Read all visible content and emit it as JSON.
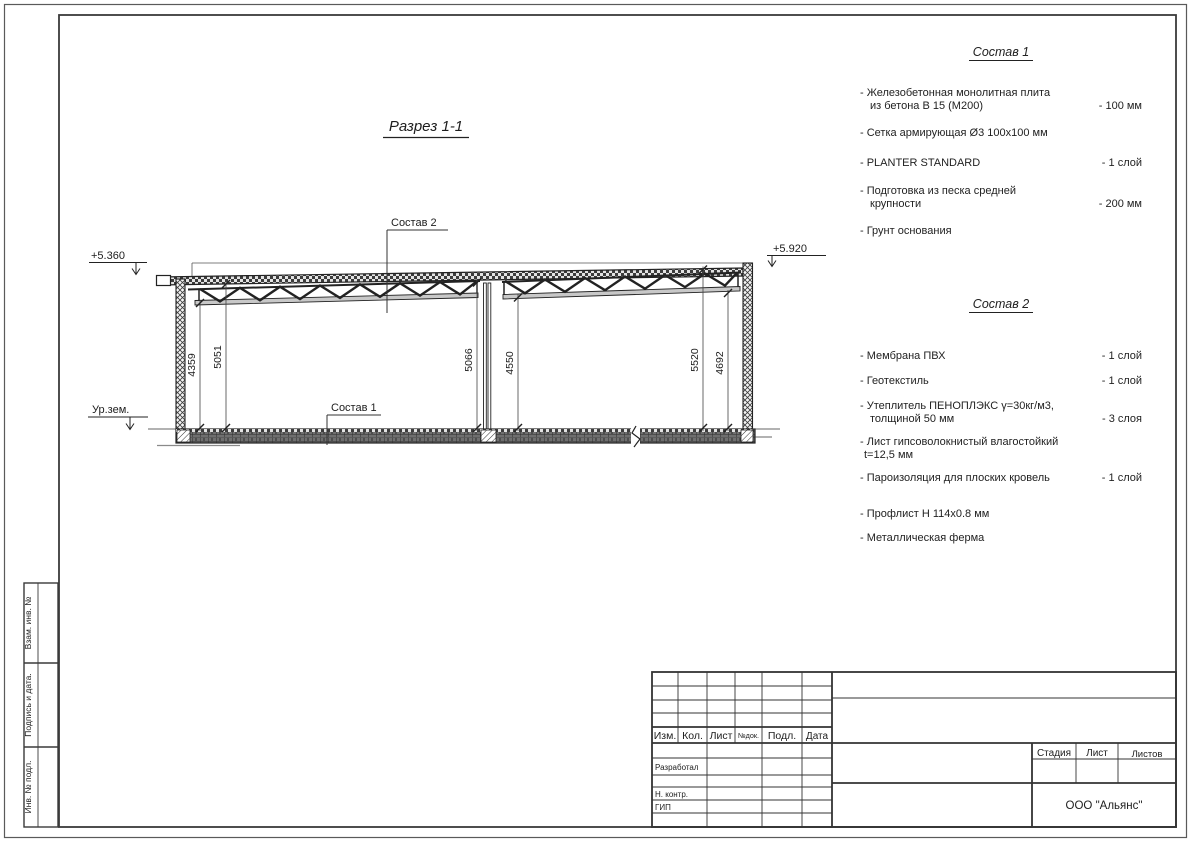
{
  "sheet": {
    "section_title": "Разрез 1-1",
    "elevations": {
      "left": "+5.360",
      "right": "+5.920",
      "ground": "Ур.зем."
    },
    "leaders": {
      "sostav1": "Состав 1",
      "sostav2": "Состав 2"
    },
    "dimensions": {
      "d1": "4359",
      "d2": "5051",
      "d3": "5066",
      "d4": "4550",
      "d5": "5520",
      "d6": "4692"
    }
  },
  "spec1": {
    "title": "Состав 1",
    "items": [
      {
        "l1": "- Железобетонная  монолитная плита",
        "l2": "из бетона В 15 (М200)",
        "v": "- 100 мм"
      },
      {
        "l1": "- Сетка армирующая Ø3 100х100 мм",
        "l2": "",
        "v": ""
      },
      {
        "l1": "- PLANTER STANDARD",
        "l2": "",
        "v": "- 1  слой"
      },
      {
        "l1": "- Подготовка из песка средней",
        "l2": "крупности",
        "v": "- 200 мм"
      },
      {
        "l1": "- Грунт основания",
        "l2": "",
        "v": ""
      }
    ]
  },
  "spec2": {
    "title": "Состав 2",
    "items": [
      {
        "l1": "- Мембрана ПВХ",
        "l2": "",
        "v": "- 1 слой"
      },
      {
        "l1": "- Геотекстиль",
        "l2": "",
        "v": "- 1 слой"
      },
      {
        "l1": "- Утеплитель ПЕНОПЛЭКС γ=30кг/м3,",
        "l2": "толщиной 50 мм",
        "v": "- 3 слоя"
      },
      {
        "l1": "- Лист гипсоволокнистый влагостойкий",
        "l2": "t=12,5 мм",
        "v": ""
      },
      {
        "l1": "- Пароизоляция для плоских кровель",
        "l2": "",
        "v": "- 1 слой"
      },
      {
        "l1": "- Профлист Н 114х0.8 мм",
        "l2": "",
        "v": ""
      },
      {
        "l1": "- Металлическая ферма",
        "l2": "",
        "v": ""
      }
    ]
  },
  "titleblock": {
    "cols": {
      "izm": "Изм.",
      "kol": "Кол.",
      "list": "Лист",
      "ndok": "№док.",
      "podl": "Подл.",
      "data": "Дата"
    },
    "roles": {
      "developed": "Разработал",
      "ncontr": "Н. контр.",
      "gip": "ГИП"
    },
    "stage": {
      "stadia": "Стадия",
      "list": "Лист",
      "listov": "Листов"
    },
    "company": "ООО \"Альянс\""
  },
  "sidebar": {
    "vzam": "Взам. инв. №",
    "podpis": "Подпись  и  дата.",
    "inv": "Инв. № подл."
  }
}
